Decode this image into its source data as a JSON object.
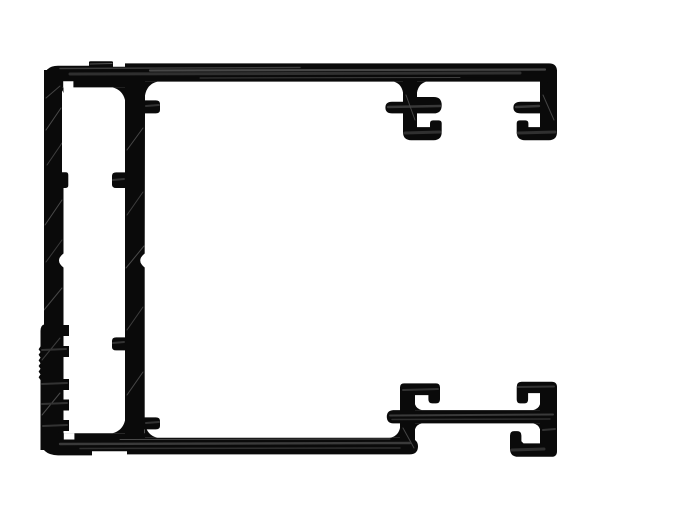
{
  "drawing": {
    "type": "technical-cross-section",
    "subject": "aluminum-extrusion-profile",
    "ink_color": "#0a0a0a",
    "paper_color": "#ffffff",
    "width": 700,
    "height": 525,
    "paths": {
      "top_rail": "M 58,65.7 L 89,65.7 L 89,62.2 Q 89,61.2 90.5,61.2 L 111.5,61.2 Q 113,61.2 113,62.2 L 113,66.8 L 125,66.8 L 125,63.4 L 549,63.4 Q 557,63.4 557,71.4 L 557,81.6 L 125,81.6 L 125,87.4 L 44,87.4 L 44,79.7 Q 44,65.7 58,65.7 Z",
      "outer_left_wall": "M 44,70 L 62,70 L 62,172.3 L 65.6,172.3 Q 68.3,172.3 68.3,175 L 68.3,185.3 Q 68.3,188 65.6,188 L 63.5,188 L 63.5,253.5 Q 54.5,260.5 63.5,267.5 L 63.5,325 L 69,325 L 69,336 L 63.5,336 L 63.5,346 L 69,346 L 69,357 L 63.5,357 L 63.5,379 L 69,379 L 69,390 L 63.5,390 L 63.5,399.5 L 69,399.5 L 69,410.5 L 63.5,410.5 L 63.5,420 L 69,420 L 69,431 L 63.5,431 L 63.5,450 L 40.5,450 L 40.5,380 L 38.6,377.2 L 40.5,374.4 L 38.6,371.6 L 40.5,368.8 L 38.6,366 L 40.5,363.2 L 38.6,360.4 L 40.5,357.6 L 38.6,354.8 L 40.5,352 L 38.6,349.2 L 40.5,346.4 L 40.5,331 Q 40.5,325.5 44,324.5 L 44,70 Z",
      "inner_left_wall": "M 125,75 L 145,75 L 145,100.4 L 155.8,100.4 Q 160,100.4 160,103.7 L 160,110 Q 160,113.4 155.8,113.4 L 145,113.4 L 144.7,253.5 Q 135.8,260.5 144.7,267.5 L 144.7,417.4 L 155.8,417.4 Q 160,417.4 160,420.7 L 160,426 Q 160,429.4 155.8,429.4 L 144.7,429.4 L 144.7,440 L 125,440 L 125,350.4 L 116.2,350.4 Q 112,350.4 112,347.1 L 112,340.7 Q 112,337.4 116.2,337.4 L 125,337.4 L 125,188 L 116.2,188 Q 112,188 112,184.7 L 112,175.7 Q 112,172.4 116.2,172.4 L 125,172.4 Z",
      "bottom_rail": "M 56,433.2 L 145,433.2 L 145,437.8 L 409.5,437.8 Q 418,439.5 418,446.3 Q 418,454.4 409.5,454.4 L 127,454.4 L 127,451.2 L 92,451.2 L 92,455.4 L 58,455.4 Q 40.5,454.8 40.5,439 L 40.5,434 L 56,433.2 Z",
      "top_mid_hook": "M 403,75 L 417,75 L 417,97 L 433.7,97 Q 441.7,97 441.7,105.2 Q 441.7,113.4 433.7,113.4 L 417,113.4 L 417,127.1 L 430,127.1 L 430,123.4 Q 430,120.4 433,120.4 L 438.7,120.4 Q 441.7,120.4 441.7,123.4 L 441.7,132 Q 441.7,140.2 433.5,140.2 L 411.2,140.2 Q 403,140.2 403,132 L 403,113.4 L 392,113.4 Q 385.4,113.4 385.4,107.5 Q 385.4,101.7 392,101.7 L 403,101.7 Z",
      "top_right_hook": "M 540,70 L 557,70 L 557,132 Q 557,140.2 548.8,140.2 L 524.9,140.2 Q 516.7,140.2 516.7,132 L 516.7,123.4 Q 516.7,120.4 519.7,120.4 L 525.4,120.4 Q 528.4,120.4 528.4,123.4 L 528.4,127.1 L 540,127.1 L 540,113.4 L 520.9,113.4 Q 513.4,113.4 513.4,107.5 Q 513.4,101.7 520.9,101.7 L 540,101.7 Z",
      "bottom_stem_hook": "M 404,383.4 L 436,383.4 Q 440,383.4 440,387.4 L 440,399.4 Q 440,403.4 436,403.4 L 432.4,403.4 Q 428.4,403.4 428.4,399.4 L 428.4,395.1 L 415,395.1 L 415,448 Q 415,452.3 410.7,452.3 L 400,452.3 L 400,387.4 Q 400,383.4 404,383.4 Z",
      "bottom_bar": "M 393.2,410.1 Q 386.8,410.6 386.8,416.7 Q 386.8,423 393.2,423.4 L 557,423.4 L 557,410.1 Z",
      "bottom_right_hook": "M 521.7,381.8 L 551.7,381.8 Q 557,381.8 557,387.1 L 557,451.4 Q 557,456.8 551.7,456.8 L 518.2,456.8 Q 510,456.8 510,448.6 L 510,435.6 Q 510,431.1 514.1,431.1 L 517.2,431.1 Q 521.4,431.1 521.4,435.6 L 521.4,441.2 L 523.5,443.4 L 540,443.4 L 540,393.1 L 528.1,393.1 L 528.1,399.4 Q 528.1,403.4 524.6,403.4 L 520.2,403.4 Q 516.7,403.4 516.7,399.4 L 516.7,387 Q 516.7,381.8 521.7,381.8 Z",
      "fillets": "M 112.5,87.4 L 125,87.4 L 125,100 Q 122.5,90 112.5,87.4 Z M 125,420.5 Q 122.5,430.7 112.5,433.2 L 125,433.2 L 125,420.5 Z M 145,95.5 Q 147,84 157.5,81.6 L 145,81.6 Z M 145,423.8 Q 147,435.5 157.5,437.8 L 145,437.8 Z M 400,428 Q 398,436.5 389.5,437.8 L 400,437.8 Z M 540,93.5 Q 541.5,84 550,81.6 L 540,81.6 Z M 403,92.5 Q 401.5,84 394,81.6 L 403,81.6 Z M 417,92.5 Q 418.5,84 426,81.6 L 417,81.6 Z M 415,404.3 Q 416.5,409 422,410.1 L 415,410.1 Z M 540,404.3 Q 538.5,409 533,410.1 L 540,410.1 Z M 540,429.2 Q 538.5,424.5 533,423.4 L 540,423.4 Z M 415,429.2 Q 416.5,424.5 422,423.4 L 415,423.4 Z M 63.5,427 Q 62.3,431.5 57,433.2 L 63.5,433.2 Z M 63.5,93 Q 62.3,89 57,87.4 L 63.5,87.4 Z",
      "relief_notches": "M 63.2,81.2 L 73.4,81.2 L 73.4,87.5 L 63.2,87.5 Z M 63.8,433.1 L 74.4,433.1 L 74.4,439.5 L 63.8,439.5 Z"
    }
  }
}
